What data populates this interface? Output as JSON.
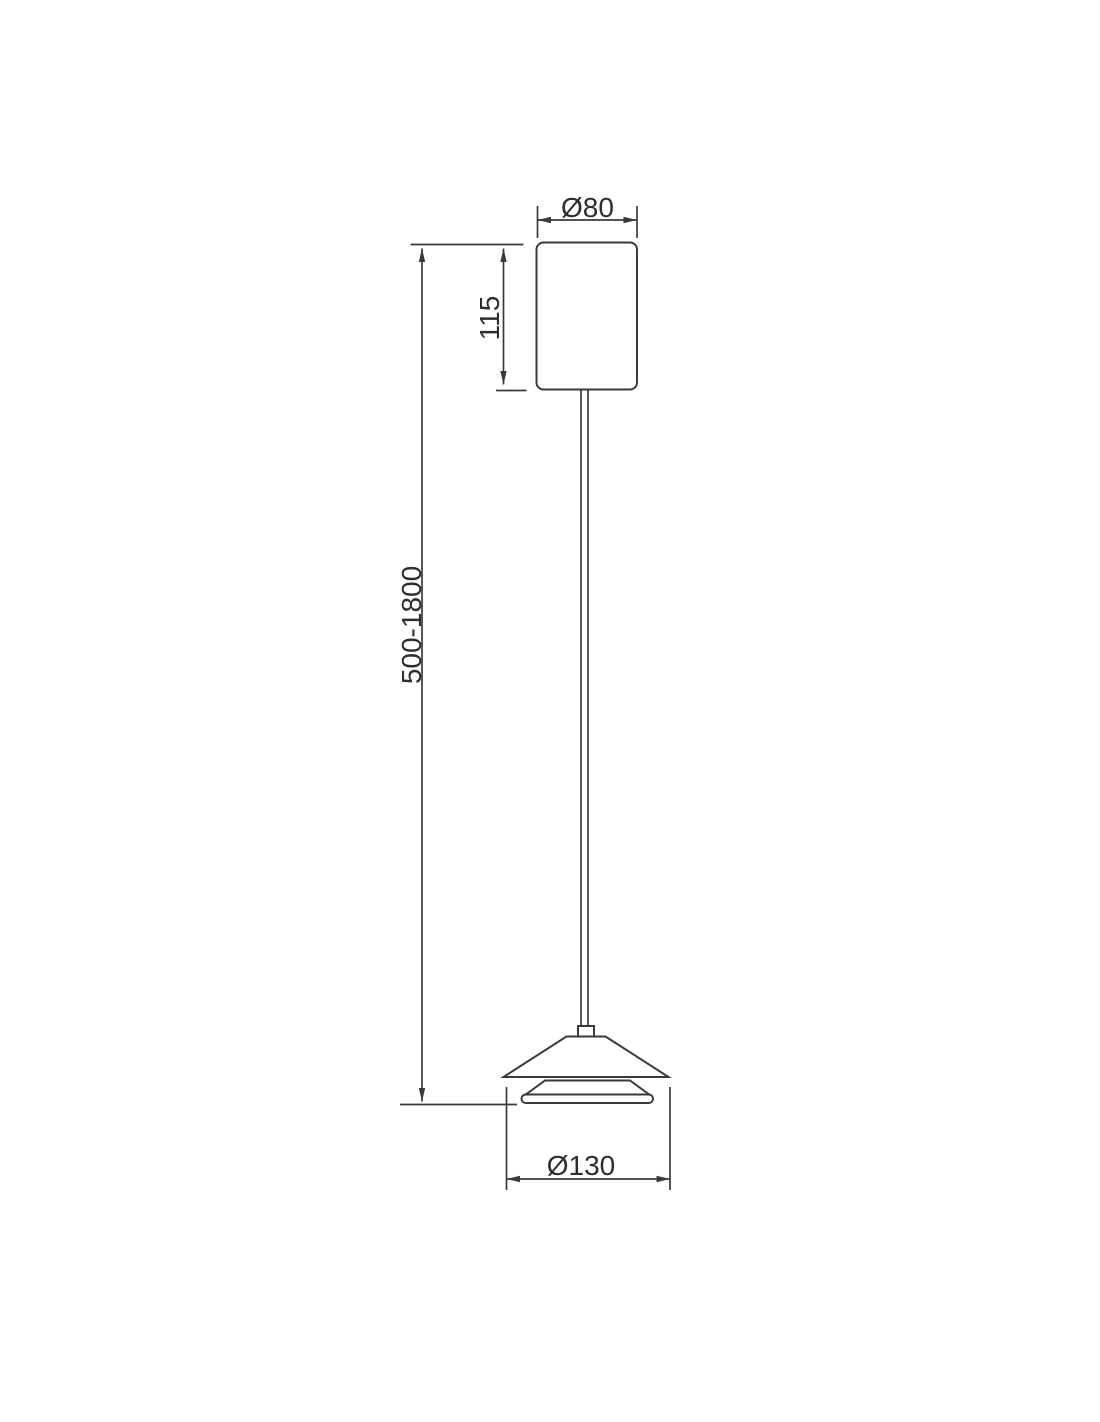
{
  "page": {
    "background": "#ffffff"
  },
  "drawing": {
    "subject": "pendant-lamp-dimension-drawing",
    "stroke_color": "#3a3a3a",
    "text_color": "#2e2e2e",
    "labels": {
      "canopy_diameter": "Ø80",
      "canopy_height": "115",
      "suspension_length": "500-1800",
      "shade_diameter": "Ø130"
    },
    "values_mm": {
      "canopy_diameter": 80,
      "canopy_height": 115,
      "suspension_length_min": 500,
      "suspension_length_max": 1800,
      "shade_diameter": 130
    }
  }
}
